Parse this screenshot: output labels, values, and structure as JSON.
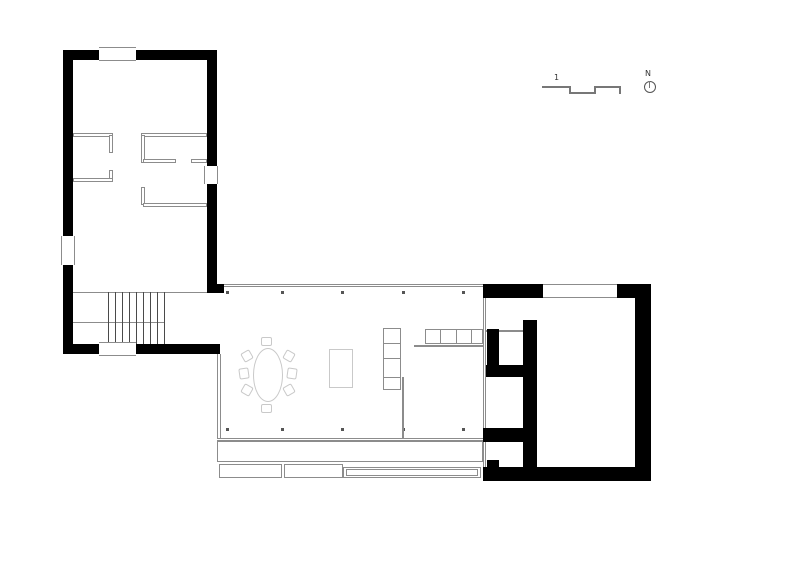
{
  "annotations": {
    "scale_label": "1",
    "north_label": "N"
  },
  "colors": {
    "wall": "#000000",
    "line": "#8c8c8c",
    "furniture": "#c9c9c9",
    "dot": "#555555",
    "tread": "#4a4a4a",
    "bar": "#777777"
  },
  "elements": [
    {
      "n": "living-top-glass-wall",
      "t": "dline-h",
      "x": 217,
      "y": 284,
      "w": 266,
      "h": 3
    },
    {
      "n": "living-bottom-glass-wall",
      "t": "dline-h",
      "x": 217,
      "y": 438,
      "w": 266,
      "h": 3
    },
    {
      "n": "living-left-wall",
      "t": "dline-v",
      "x": 217,
      "y": 354,
      "w": 4,
      "h": 84
    },
    {
      "n": "column-dot",
      "t": "dot",
      "x": 226,
      "y": 291,
      "w": 3,
      "h": 3
    },
    {
      "n": "column-dot",
      "t": "dot",
      "x": 281,
      "y": 291,
      "w": 3,
      "h": 3
    },
    {
      "n": "column-dot",
      "t": "dot",
      "x": 341,
      "y": 291,
      "w": 3,
      "h": 3
    },
    {
      "n": "column-dot",
      "t": "dot",
      "x": 402,
      "y": 291,
      "w": 3,
      "h": 3
    },
    {
      "n": "column-dot",
      "t": "dot",
      "x": 462,
      "y": 291,
      "w": 3,
      "h": 3
    },
    {
      "n": "column-dot",
      "t": "dot",
      "x": 226,
      "y": 428,
      "w": 3,
      "h": 3
    },
    {
      "n": "column-dot",
      "t": "dot",
      "x": 281,
      "y": 428,
      "w": 3,
      "h": 3
    },
    {
      "n": "column-dot",
      "t": "dot",
      "x": 341,
      "y": 428,
      "w": 3,
      "h": 3
    },
    {
      "n": "column-dot",
      "t": "dot",
      "x": 402,
      "y": 428,
      "w": 3,
      "h": 3
    },
    {
      "n": "column-dot",
      "t": "dot",
      "x": 462,
      "y": 428,
      "w": 3,
      "h": 3
    },
    {
      "n": "dining-table",
      "t": "ellipse",
      "x": 253,
      "y": 348,
      "w": 30,
      "h": 54
    },
    {
      "n": "dining-chair",
      "t": "chair",
      "x": 261,
      "y": 337,
      "w": 11,
      "h": 9,
      "r": 0
    },
    {
      "n": "dining-chair",
      "t": "chair",
      "x": 261,
      "y": 404,
      "w": 11,
      "h": 9,
      "r": 0
    },
    {
      "n": "dining-chair",
      "t": "chair",
      "x": 242,
      "y": 351,
      "w": 10,
      "h": 10,
      "r": -30
    },
    {
      "n": "dining-chair",
      "t": "chair",
      "x": 239,
      "y": 368,
      "w": 10,
      "h": 11,
      "r": -8
    },
    {
      "n": "dining-chair",
      "t": "chair",
      "x": 242,
      "y": 385,
      "w": 10,
      "h": 10,
      "r": 30
    },
    {
      "n": "dining-chair",
      "t": "chair",
      "x": 284,
      "y": 351,
      "w": 10,
      "h": 10,
      "r": 30
    },
    {
      "n": "dining-chair",
      "t": "chair",
      "x": 287,
      "y": 368,
      "w": 10,
      "h": 11,
      "r": 8
    },
    {
      "n": "dining-chair",
      "t": "chair",
      "x": 284,
      "y": 385,
      "w": 10,
      "h": 10,
      "r": -30
    },
    {
      "n": "rug",
      "t": "outline",
      "x": 329,
      "y": 349,
      "w": 24,
      "h": 39
    },
    {
      "n": "shelf-vertical",
      "t": "outline-dark",
      "x": 383,
      "y": 328,
      "w": 18,
      "h": 62
    },
    {
      "n": "shelf-divider",
      "t": "line",
      "x": 383,
      "y": 343,
      "w": 18,
      "h": 1
    },
    {
      "n": "shelf-divider",
      "t": "line",
      "x": 383,
      "y": 358,
      "w": 18,
      "h": 1
    },
    {
      "n": "shelf-divider",
      "t": "line",
      "x": 383,
      "y": 377,
      "w": 18,
      "h": 1
    },
    {
      "n": "screen-partition-line",
      "t": "line",
      "x": 402,
      "y": 377,
      "w": 2,
      "h": 61
    },
    {
      "n": "shelf-horizontal",
      "t": "outline-dark",
      "x": 425,
      "y": 329,
      "w": 58,
      "h": 15
    },
    {
      "n": "shelf-divider",
      "t": "line",
      "x": 440,
      "y": 329,
      "w": 1,
      "h": 15
    },
    {
      "n": "shelf-divider",
      "t": "line",
      "x": 456,
      "y": 329,
      "w": 1,
      "h": 15
    },
    {
      "n": "shelf-divider",
      "t": "line",
      "x": 471,
      "y": 329,
      "w": 1,
      "h": 15
    },
    {
      "n": "counter-line",
      "t": "line",
      "x": 414,
      "y": 345,
      "w": 69,
      "h": 2
    },
    {
      "n": "terrace-deck",
      "t": "outline-dark",
      "x": 217,
      "y": 441,
      "w": 266,
      "h": 21
    },
    {
      "n": "terrace-step-1",
      "t": "outline-dark",
      "x": 219,
      "y": 464,
      "w": 63,
      "h": 14
    },
    {
      "n": "terrace-step-2",
      "t": "outline-dark",
      "x": 284,
      "y": 464,
      "w": 59,
      "h": 14
    },
    {
      "n": "terrace-step-3",
      "t": "outline-dark",
      "x": 343,
      "y": 467,
      "w": 138,
      "h": 11
    },
    {
      "n": "terrace-step-3-inner",
      "t": "outline-dark",
      "x": 346,
      "y": 469,
      "w": 132,
      "h": 7
    },
    {
      "n": "stair-landing-line",
      "t": "line",
      "x": 73,
      "y": 292,
      "w": 134,
      "h": 1
    },
    {
      "n": "stair-mid-line",
      "t": "line",
      "x": 73,
      "y": 322,
      "w": 91,
      "h": 1
    },
    {
      "n": "stair-tread",
      "t": "tread",
      "x": 108,
      "y": 292,
      "w": 1,
      "h": 52
    },
    {
      "n": "stair-tread",
      "t": "tread",
      "x": 115,
      "y": 292,
      "w": 1,
      "h": 52
    },
    {
      "n": "stair-tread",
      "t": "tread",
      "x": 122,
      "y": 292,
      "w": 1,
      "h": 52
    },
    {
      "n": "stair-tread",
      "t": "tread",
      "x": 129,
      "y": 292,
      "w": 1,
      "h": 52
    },
    {
      "n": "stair-tread",
      "t": "tread",
      "x": 136,
      "y": 292,
      "w": 1,
      "h": 52
    },
    {
      "n": "stair-tread",
      "t": "tread",
      "x": 143,
      "y": 292,
      "w": 1,
      "h": 52
    },
    {
      "n": "stair-tread",
      "t": "tread",
      "x": 150,
      "y": 292,
      "w": 1,
      "h": 52
    },
    {
      "n": "stair-tread",
      "t": "tread",
      "x": 157,
      "y": 292,
      "w": 1,
      "h": 52
    },
    {
      "n": "stair-tread",
      "t": "tread",
      "x": 164,
      "y": 292,
      "w": 1,
      "h": 52
    },
    {
      "n": "left-block-top-wall-a",
      "t": "wall",
      "x": 63,
      "y": 50,
      "w": 36,
      "h": 10
    },
    {
      "n": "left-block-top-wall-b",
      "t": "wall",
      "x": 136,
      "y": 50,
      "w": 81,
      "h": 10
    },
    {
      "n": "left-block-left-wall-a",
      "t": "wall",
      "x": 63,
      "y": 50,
      "w": 10,
      "h": 186
    },
    {
      "n": "left-block-left-wall-b",
      "t": "wall",
      "x": 63,
      "y": 265,
      "w": 10,
      "h": 89
    },
    {
      "n": "left-block-right-wall-a",
      "t": "wall",
      "x": 207,
      "y": 50,
      "w": 10,
      "h": 116
    },
    {
      "n": "left-block-right-wall-b",
      "t": "wall",
      "x": 207,
      "y": 184,
      "w": 10,
      "h": 109
    },
    {
      "n": "left-block-bottom-wall-a",
      "t": "wall",
      "x": 63,
      "y": 344,
      "w": 36,
      "h": 10
    },
    {
      "n": "left-block-bottom-wall-b",
      "t": "wall",
      "x": 136,
      "y": 344,
      "w": 84,
      "h": 10
    },
    {
      "n": "corner-stub",
      "t": "wall",
      "x": 216,
      "y": 284,
      "w": 8,
      "h": 9
    },
    {
      "n": "window",
      "t": "window-h",
      "x": 99,
      "y": 47,
      "w": 37,
      "h": 14
    },
    {
      "n": "window",
      "t": "window-v",
      "x": 61,
      "y": 236,
      "w": 14,
      "h": 29
    },
    {
      "n": "window",
      "t": "window-v",
      "x": 204,
      "y": 166,
      "w": 14,
      "h": 18
    },
    {
      "n": "window",
      "t": "window-h",
      "x": 99,
      "y": 342,
      "w": 37,
      "h": 14
    },
    {
      "n": "partition",
      "t": "thinwall",
      "x": 73,
      "y": 133,
      "w": 40,
      "h": 4
    },
    {
      "n": "partition",
      "t": "thinwall",
      "x": 109,
      "y": 135,
      "w": 4,
      "h": 18
    },
    {
      "n": "partition",
      "t": "thinwall",
      "x": 73,
      "y": 178,
      "w": 40,
      "h": 4
    },
    {
      "n": "partition",
      "t": "thinwall",
      "x": 109,
      "y": 170,
      "w": 4,
      "h": 9
    },
    {
      "n": "partition",
      "t": "thinwall",
      "x": 141,
      "y": 133,
      "w": 66,
      "h": 4
    },
    {
      "n": "partition",
      "t": "thinwall",
      "x": 141,
      "y": 135,
      "w": 4,
      "h": 28
    },
    {
      "n": "partition",
      "t": "thinwall",
      "x": 143,
      "y": 159,
      "w": 33,
      "h": 4
    },
    {
      "n": "partition",
      "t": "thinwall",
      "x": 191,
      "y": 159,
      "w": 16,
      "h": 4
    },
    {
      "n": "partition",
      "t": "thinwall",
      "x": 141,
      "y": 187,
      "w": 4,
      "h": 18
    },
    {
      "n": "partition",
      "t": "thinwall",
      "x": 143,
      "y": 203,
      "w": 64,
      "h": 4
    },
    {
      "n": "right-block-left-line",
      "t": "dline-v",
      "x": 483,
      "y": 296,
      "w": 3,
      "h": 171
    },
    {
      "n": "right-block-cell-door-line",
      "t": "line",
      "x": 486,
      "y": 330,
      "w": 37,
      "h": 2
    },
    {
      "n": "right-block-top-wall-a",
      "t": "wall",
      "x": 483,
      "y": 284,
      "w": 60,
      "h": 14
    },
    {
      "n": "right-block-top-wall-b",
      "t": "wall",
      "x": 617,
      "y": 284,
      "w": 34,
      "h": 14
    },
    {
      "n": "window",
      "t": "window-h",
      "x": 543,
      "y": 284,
      "w": 74,
      "h": 14
    },
    {
      "n": "right-block-right-wall",
      "t": "wall",
      "x": 635,
      "y": 284,
      "w": 16,
      "h": 197
    },
    {
      "n": "right-block-bottom-wall",
      "t": "wall",
      "x": 483,
      "y": 467,
      "w": 168,
      "h": 14
    },
    {
      "n": "right-block-core-wall",
      "t": "wall",
      "x": 523,
      "y": 320,
      "w": 14,
      "h": 147
    },
    {
      "n": "right-block-cell-wall",
      "t": "wall",
      "x": 487,
      "y": 329,
      "w": 12,
      "h": 36
    },
    {
      "n": "right-block-separator-1",
      "t": "wall",
      "x": 486,
      "y": 365,
      "w": 51,
      "h": 12
    },
    {
      "n": "right-block-separator-2",
      "t": "wall",
      "x": 483,
      "y": 428,
      "w": 54,
      "h": 14
    },
    {
      "n": "right-block-bottom-stub",
      "t": "wall",
      "x": 487,
      "y": 460,
      "w": 12,
      "h": 7
    },
    {
      "n": "scale-bar-segment",
      "t": "bar",
      "x": 542,
      "y": 86,
      "w": 29,
      "h": 2
    },
    {
      "n": "scale-bar-step",
      "t": "bar",
      "x": 569,
      "y": 86,
      "w": 2,
      "h": 8
    },
    {
      "n": "scale-bar-segment",
      "t": "bar",
      "x": 569,
      "y": 92,
      "w": 27,
      "h": 2
    },
    {
      "n": "scale-bar-step",
      "t": "bar",
      "x": 594,
      "y": 86,
      "w": 2,
      "h": 8
    },
    {
      "n": "scale-bar-segment",
      "t": "bar",
      "x": 594,
      "y": 86,
      "w": 27,
      "h": 2
    },
    {
      "n": "scale-bar-end-tick",
      "t": "bar",
      "x": 619,
      "y": 86,
      "w": 2,
      "h": 8
    },
    {
      "n": "scale-label",
      "t": "text",
      "x": 554,
      "y": 74,
      "w": 10,
      "h": 9,
      "bind": "annotations.scale_label"
    },
    {
      "n": "north-label",
      "t": "text",
      "x": 645,
      "y": 70,
      "w": 10,
      "h": 9,
      "bind": "annotations.north_label"
    },
    {
      "n": "north-arrow-icon",
      "t": "circle",
      "x": 644,
      "y": 81,
      "w": 12,
      "h": 12
    },
    {
      "n": "north-needle",
      "t": "bar",
      "x": 649,
      "y": 81,
      "w": 1,
      "h": 7
    }
  ]
}
